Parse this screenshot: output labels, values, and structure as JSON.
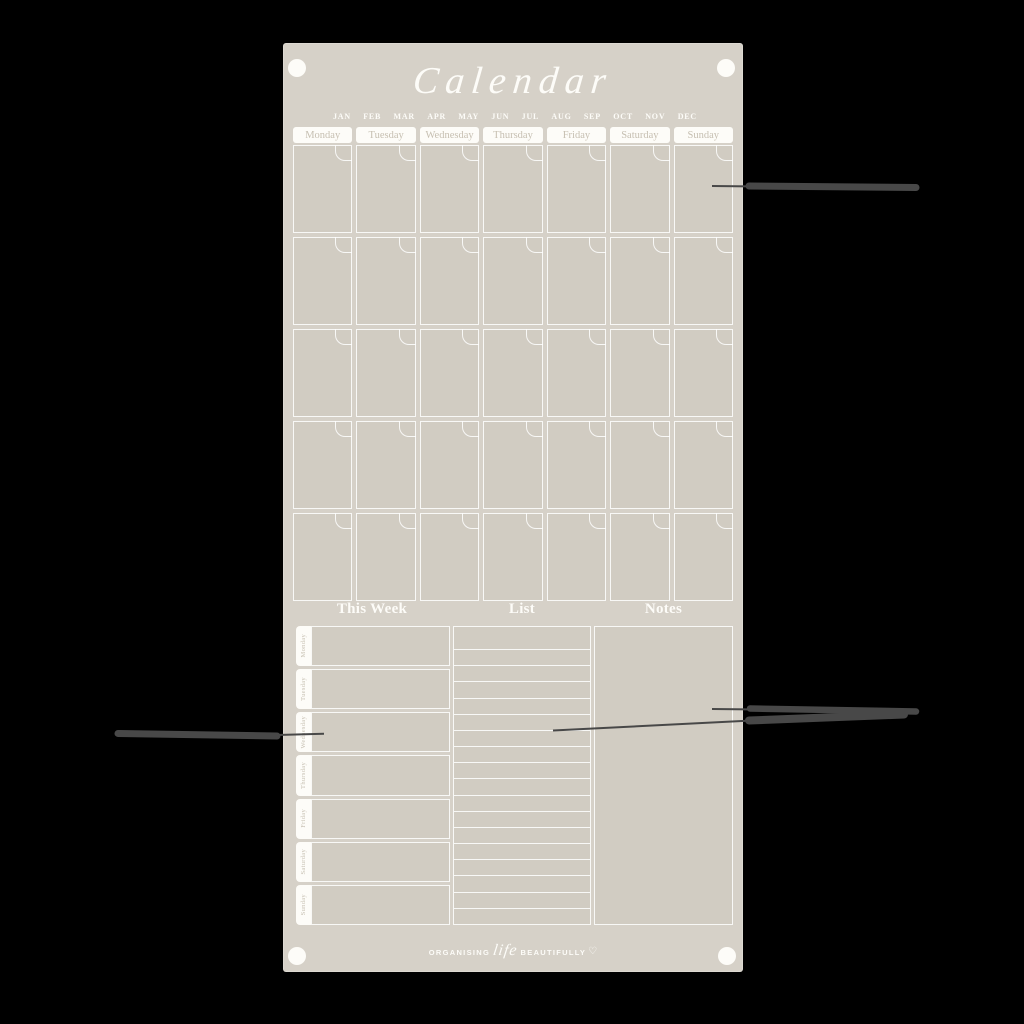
{
  "colors": {
    "background": "#000000",
    "panel": "#d6d1c8",
    "cell": "#d1ccc2",
    "white": "#fdfcf8",
    "muted_text": "#c6bfb1",
    "callout_line": "#484848"
  },
  "board": {
    "title": "Calendar",
    "months": [
      "JAN",
      "FEB",
      "MAR",
      "APR",
      "MAY",
      "JUN",
      "JUL",
      "AUG",
      "SEP",
      "OCT",
      "NOV",
      "DEC"
    ],
    "weekday_headers": [
      "Monday",
      "Tuesday",
      "Wednesday",
      "Thursday",
      "Friday",
      "Saturday",
      "Sunday"
    ],
    "grid": {
      "rows": 5,
      "cols": 7,
      "cell_count": 35
    },
    "sections": {
      "this_week": "This Week",
      "list": "List",
      "notes": "Notes"
    },
    "week_rows": [
      "Monday",
      "Tuesday",
      "Wednesday",
      "Thursday",
      "Friday",
      "Saturday",
      "Sunday"
    ],
    "list": {
      "line_count": 17
    },
    "footer": {
      "left": "ORGANISING",
      "script": "life",
      "right": "BEAUTIFULLY",
      "heart": "♡"
    }
  }
}
